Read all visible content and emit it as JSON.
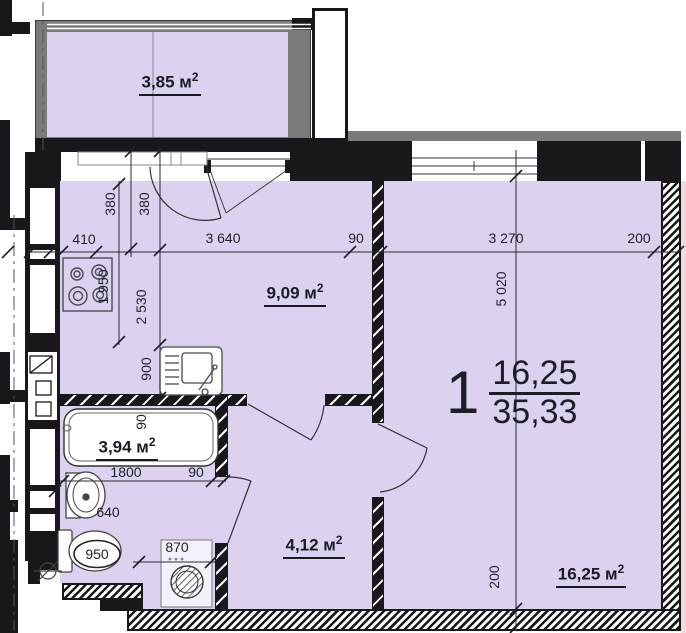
{
  "plan": {
    "apartment": {
      "rooms_count": "1",
      "upper_area": "16,25",
      "lower_area": "35,33"
    },
    "areas": {
      "balcony": {
        "value": "3,85 м",
        "sup": "2"
      },
      "kitchen": {
        "value": "9,09 м",
        "sup": "2"
      },
      "bathroom": {
        "value": "3,94 м",
        "sup": "2"
      },
      "hallway": {
        "value": "4,12 м",
        "sup": "2"
      },
      "living_room": {
        "value": "16,25 м",
        "sup": "2"
      }
    },
    "dimensions": {
      "top_410": "410",
      "top_3640": "3 640",
      "top_90": "90",
      "top_3270": "3 270",
      "top_200": "200",
      "left_380a": "380",
      "left_380b": "380",
      "left_1950": "1 950",
      "left_2530": "2 530",
      "left_900": "900",
      "right_5020": "5 020",
      "right_200": "200",
      "bath_90v": "90",
      "bath_1800": "1800",
      "bath_90": "90",
      "bath_640": "640",
      "bath_950": "950",
      "bath_870": "870"
    },
    "colors": {
      "room_fill": "#dcd1ee",
      "neighbor_fill": "#f2dbdb",
      "balcony_wall": "#7b7b7b",
      "wall": "#17171c"
    }
  }
}
